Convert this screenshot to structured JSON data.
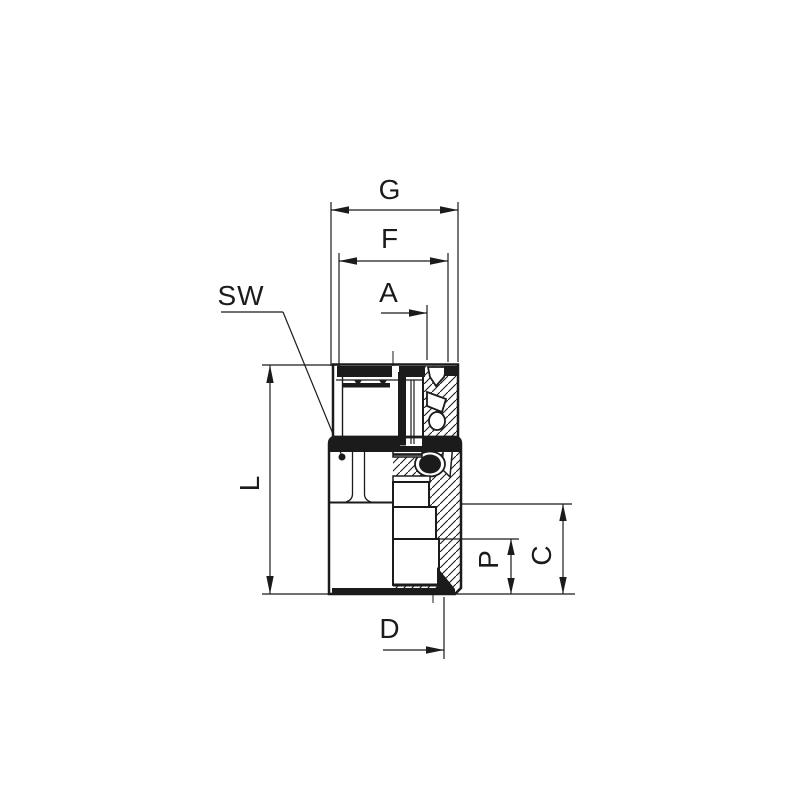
{
  "drawing": {
    "type_note": "half-section technical drawing of a push-in tube fitting with female thread",
    "colors": {
      "line": "#1b1b1b",
      "background": "#ffffff"
    },
    "labels": {
      "g": "G",
      "f": "F",
      "a": "A",
      "sw": "SW",
      "l": "L",
      "p": "P",
      "c": "C",
      "d": "D"
    }
  }
}
